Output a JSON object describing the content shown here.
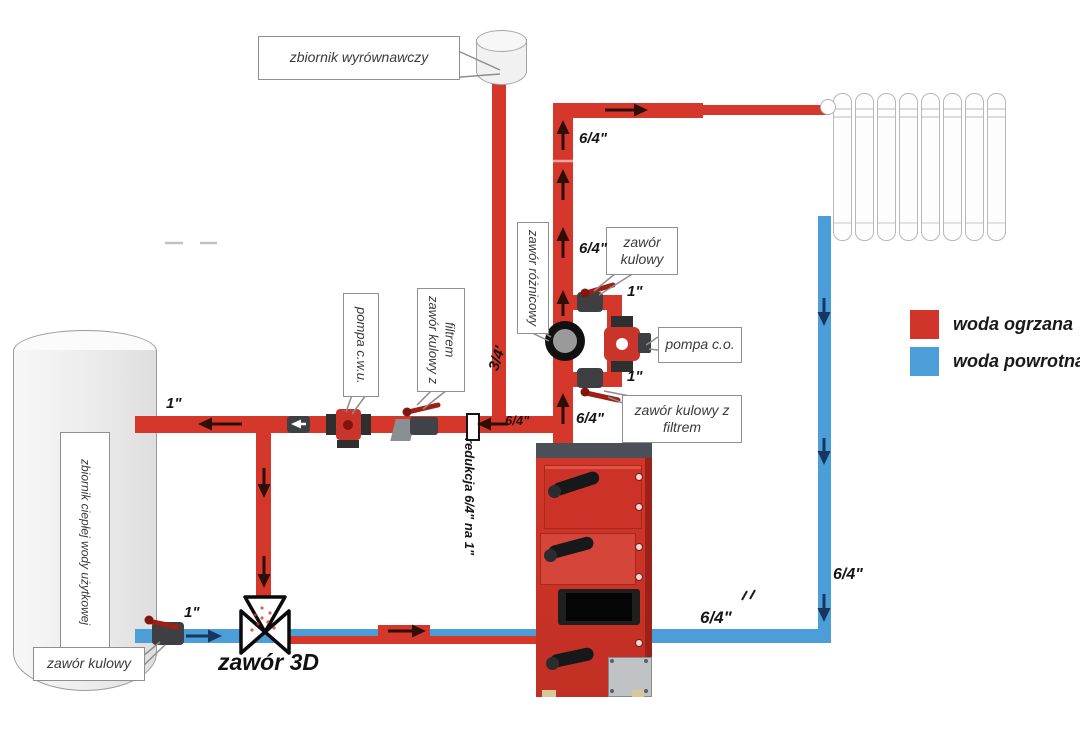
{
  "legend": {
    "hot": {
      "label": "woda ogrzana",
      "color": "#d0342a"
    },
    "return": {
      "label": "woda powrotna",
      "color": "#4c9ed8"
    }
  },
  "components": {
    "expansion_tank_label": "zbiornik wyrównawczy",
    "dhw_tank_label": "zbiornik ciepłej wody użytkowej",
    "dhw_pump_label": "pompa c.w.u.",
    "ball_valve_filter_label": "zawór kulowy z filtrem",
    "diff_valve_label": "zawór różnicowy",
    "ball_valve_label": "zawór kulowy",
    "co_pump_label": "pompa c.o.",
    "boiler_valve_filter_label": "zawór kulowy z filtrem",
    "valve_3d_label": "zawór 3D",
    "tank_ball_valve_label": "zawór kulowy",
    "reduction_label": "redukcja 6/4\" na 1\""
  },
  "pipe_sizes": {
    "riser_top": "6/4\"",
    "riser_mid": "6/4\"",
    "riser_bottom": "6/4\"",
    "expansion_pipe": "3/4'",
    "dhw_supply": "1\"",
    "dhw_supply_mid": "6/4\"",
    "bypass_top": "1\"",
    "bypass_bottom": "1\"",
    "tank_return": "1\"",
    "return_bottom": "6/4\"",
    "return_right": "6/4\""
  }
}
